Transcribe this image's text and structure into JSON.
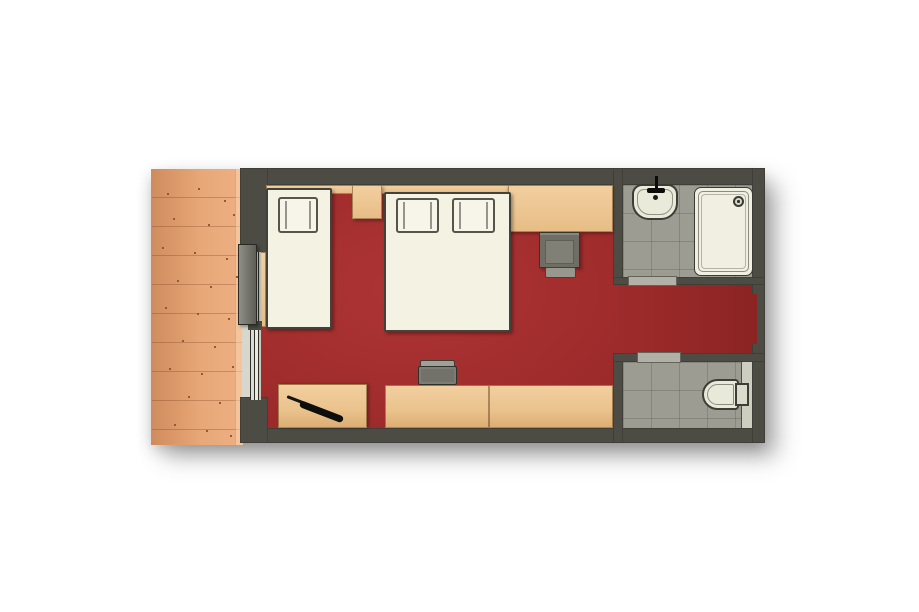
{
  "meta": {
    "type": "floor-plan",
    "description": "Top-down rendered floor plan of a hotel room: wooden balcony deck on the left, bedroom with red carpet containing a single bed, a double bed, desks and chairs, a central hallway, a shower bathroom and a separate WC room on the right.",
    "visible_text": []
  },
  "palette": {
    "background": "#ffffff",
    "wall": "#4c4c45",
    "carpet_red": "#9e2b2b",
    "deck_wood": "#e4a173",
    "furniture_wood": "#ecc694",
    "bathroom_tile": "#9c9c92",
    "fixture_white": "#f0efe1",
    "chair_gray": "#6e6e65",
    "bed_linen": "#f4f2e3"
  },
  "labels": {
    "plan": "Hotel room floor plan",
    "deck": "Wooden balcony deck",
    "main_room": "Bedroom with red carpet",
    "hallway": "Entrance hallway",
    "bath_shower": "Bathroom with washbasin and shower",
    "bath_wc": "Separate toilet room",
    "single_bed": "Single bed with pillow",
    "double_bed": "Double bed with two pillows",
    "nightstand": "Bedside shelf",
    "console": "Luggage bench",
    "armchair": "Armchair",
    "footstool": "Footstool",
    "desk_left": "Side desk with pen",
    "desk_right": "Long desk",
    "desk_chair": "Desk chair",
    "pen": "Pen on desk",
    "sink": "Washbasin with faucet",
    "shower": "Shower tray with drain",
    "toilet": "Toilet with cistern",
    "door": "Sliding glass door to deck",
    "window": "Glazed door and window track",
    "threshold1": "Bathroom doorway threshold",
    "threshold2": "Toilet room doorway threshold",
    "entrance": "Entrance recess"
  },
  "inventory": {
    "areas": [
      "balcony deck",
      "bedroom",
      "hallway",
      "shower bathroom",
      "wc room"
    ],
    "furniture": [
      "single bed",
      "double bed",
      "bedside shelf",
      "luggage bench",
      "armchair",
      "footstool",
      "side desk",
      "long desk",
      "desk chair"
    ],
    "fixtures": [
      "washbasin",
      "shower tray",
      "toilet"
    ],
    "openings": [
      "sliding glass door to deck",
      "bathroom doorway",
      "wc doorway",
      "entrance recess"
    ]
  }
}
